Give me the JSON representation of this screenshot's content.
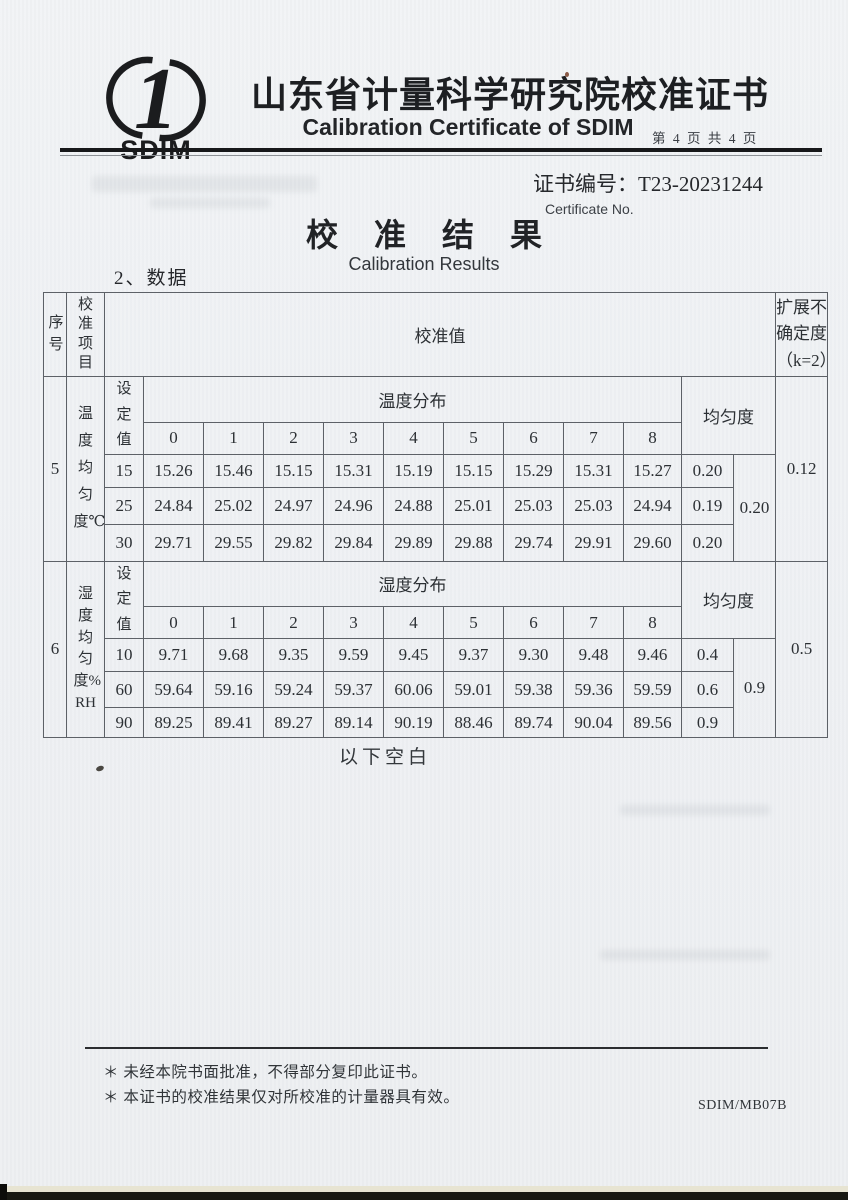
{
  "header": {
    "logo_text": "SDIM",
    "title_cn": "山东省计量科学研究院校准证书",
    "title_en": "Calibration Certificate of SDIM",
    "page_info": "第 4 页 共 4 页"
  },
  "certificate": {
    "number_line": "证书编号：T23-20231244",
    "number_sub": "Certificate No."
  },
  "results": {
    "title_cn": "校 准 结 果",
    "title_en": "Calibration Results",
    "data_label": "2、数据"
  },
  "table": {
    "col_headers": {
      "seq": "序号",
      "item": "校准项目",
      "value": "校准值",
      "uncertainty": "扩展不\n确定度\n（k=2）"
    },
    "point_labels": [
      "0",
      "1",
      "2",
      "3",
      "4",
      "5",
      "6",
      "7",
      "8"
    ],
    "sections": [
      {
        "seq": "5",
        "item": "温度均匀度℃",
        "set_label": "设定值",
        "dist_label": "温度分布",
        "uniformity_label": "均匀度",
        "rows": [
          {
            "set": "15",
            "values": [
              "15.26",
              "15.46",
              "15.15",
              "15.31",
              "15.19",
              "15.15",
              "15.29",
              "15.31",
              "15.27"
            ],
            "uniformity": "0.20"
          },
          {
            "set": "25",
            "values": [
              "24.84",
              "25.02",
              "24.97",
              "24.96",
              "24.88",
              "25.01",
              "25.03",
              "25.03",
              "24.94"
            ],
            "uniformity": "0.19"
          },
          {
            "set": "30",
            "values": [
              "29.71",
              "29.55",
              "29.82",
              "29.84",
              "29.89",
              "29.88",
              "29.74",
              "29.91",
              "29.60"
            ],
            "uniformity": "0.20"
          }
        ],
        "max_uniformity": "0.20",
        "expanded_uncertainty": "0.12"
      },
      {
        "seq": "6",
        "item": "湿度均匀度%RH",
        "set_label": "设定值",
        "dist_label": "湿度分布",
        "uniformity_label": "均匀度",
        "rows": [
          {
            "set": "10",
            "values": [
              "9.71",
              "9.68",
              "9.35",
              "9.59",
              "9.45",
              "9.37",
              "9.30",
              "9.48",
              "9.46"
            ],
            "uniformity": "0.4"
          },
          {
            "set": "60",
            "values": [
              "59.64",
              "59.16",
              "59.24",
              "59.37",
              "60.06",
              "59.01",
              "59.38",
              "59.36",
              "59.59"
            ],
            "uniformity": "0.6"
          },
          {
            "set": "90",
            "values": [
              "89.25",
              "89.41",
              "89.27",
              "89.14",
              "90.19",
              "88.46",
              "89.74",
              "90.04",
              "89.56"
            ],
            "uniformity": "0.9"
          }
        ],
        "max_uniformity": "0.9",
        "expanded_uncertainty": "0.5"
      }
    ]
  },
  "below_blank": "以下空白",
  "footer": {
    "note1": "＊ 未经本院书面批准，不得部分复印此证书。",
    "note2": "＊ 本证书的校准结果仅对所校准的计量器具有效。",
    "form_code": "SDIM/MB07B"
  },
  "colors": {
    "paper": "#eef0f3",
    "ink": "#2c3034",
    "table_border": "#5d6167",
    "rule": "#17181a"
  }
}
